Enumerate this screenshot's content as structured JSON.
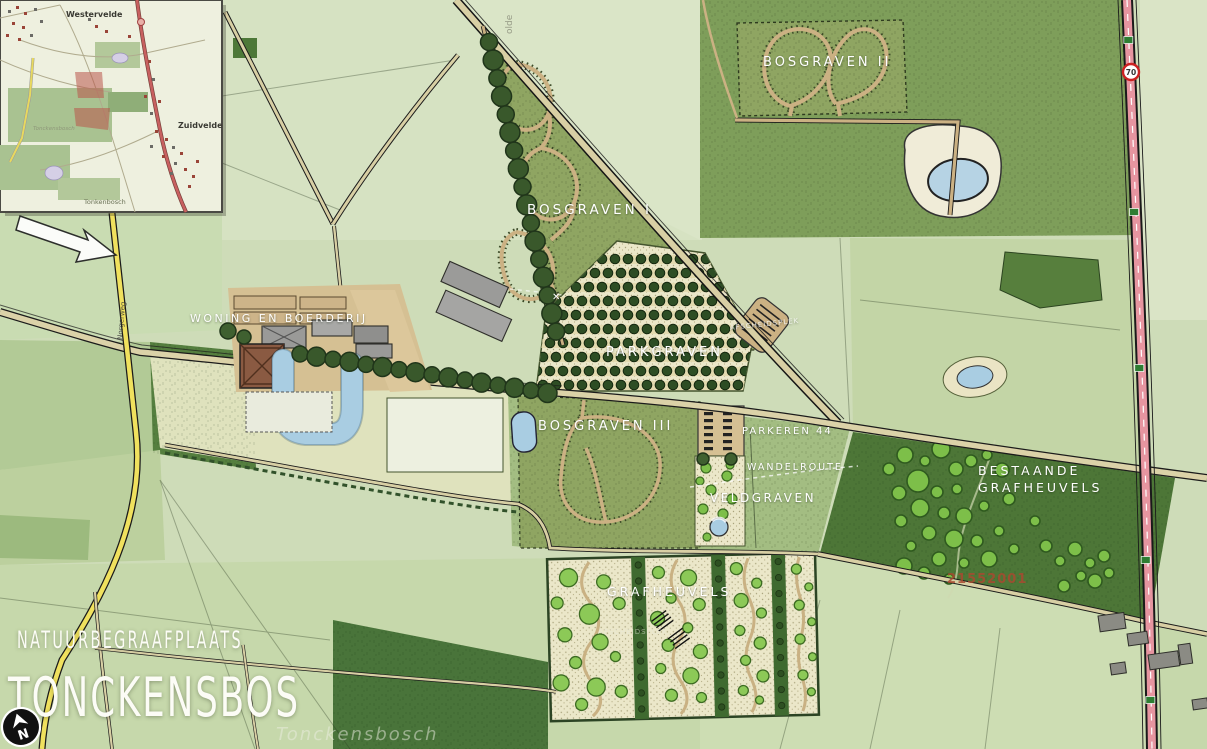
{
  "title": {
    "line1": "NATUURBEGRAAFPLAATS",
    "line2": "TONCKENSBOS",
    "watermark": "Tonckensbosch"
  },
  "north_arrow": {
    "label": "N"
  },
  "annotations": {
    "project_number": "21552001",
    "cross_mark": "✕",
    "speed_sign": "70",
    "road_name": "Norgerweg",
    "edge_label": "olde"
  },
  "areas": {
    "bosgraven1": "BOSGRAVEN I",
    "bosgraven2": "BOSGRAVEN II",
    "bosgraven3": "BOSGRAVEN III",
    "parkgraven": "PARKGRAVEN",
    "veldgraven": "VELDGRAVEN",
    "grafheuvels": "GRAFHEUVELS",
    "bestaande_line1": "BESTAANDE",
    "bestaande_line2": "GRAFHEUVELS",
    "woning": "WONING EN BOERDERIJ",
    "parkeren": "PARKEREN 44",
    "wandelroute": "WANDELROUTE",
    "afscheidsplek_oost": "AFSCHEIDSPLEK",
    "afscheidsplek_zuid": "AFSCHEIDSPLEK"
  },
  "inset": {
    "westervelde": "Westervelde",
    "zuidvelde": "Zuidvelde",
    "tonkenbosch": "Tonkenbosch",
    "tonckensbosch": "Tonckensbosch"
  },
  "colors": {
    "base_green": "#cedcb8",
    "dark_forest": "#4d7637",
    "olive_bosgraven": "#8fa562",
    "path_tan": "#cbb183",
    "road_fill": "#d8cfa4",
    "road_yellow": "#f0e15e",
    "road_pink": "#e695a0",
    "water_blue": "#a9cde2",
    "label_white": "#ffffff",
    "project_red": "#a84a30",
    "bright_tree": "#7dbf49"
  }
}
